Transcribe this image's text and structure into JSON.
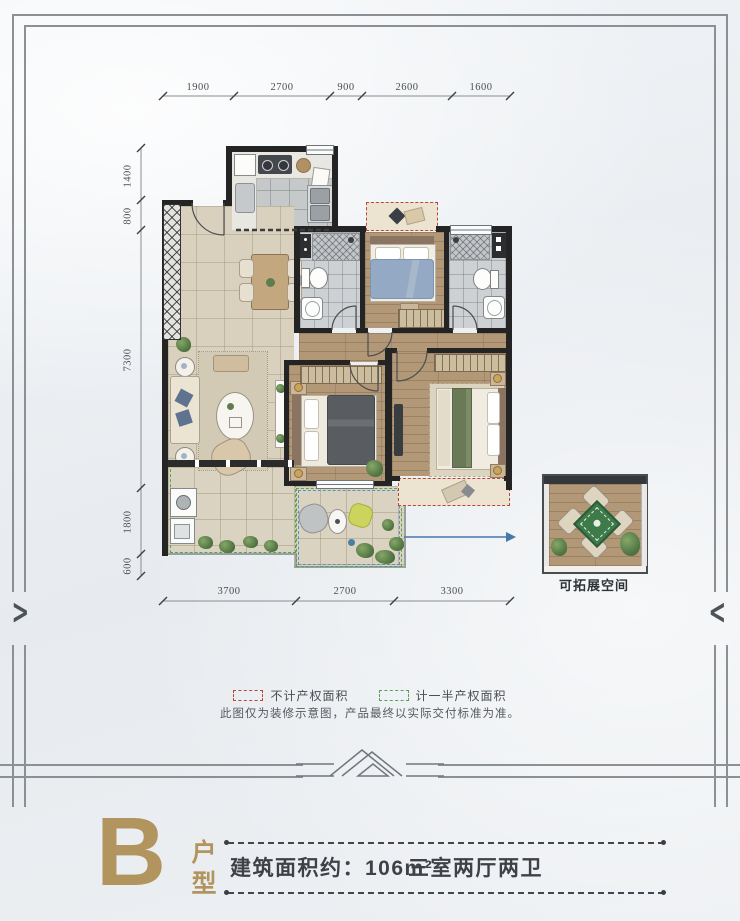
{
  "poster": {
    "dimensions": {
      "top": [
        "1900",
        "2700",
        "900",
        "2600",
        "1600"
      ],
      "left": [
        "1400",
        "800",
        "7300",
        "1800",
        "600"
      ],
      "bottom": [
        "3700",
        "2700",
        "3300"
      ]
    },
    "extension_label": "可拓展空间",
    "legend": {
      "no_property_area": "不计产权面积",
      "half_property_area": "计一半产权面积",
      "note": "此图仅为装修示意图，产品最终以实际交付标准为准。"
    },
    "title": {
      "letter": "B",
      "type": "户型",
      "area": "建筑面积约：106m²",
      "rooms": "三室两厅两卫"
    },
    "colors": {
      "gold": "#b2945e",
      "wall": "#242424",
      "red_dash": "#b5483a",
      "green_dash": "#57a355",
      "blue_arrow": "#4679a8"
    }
  }
}
